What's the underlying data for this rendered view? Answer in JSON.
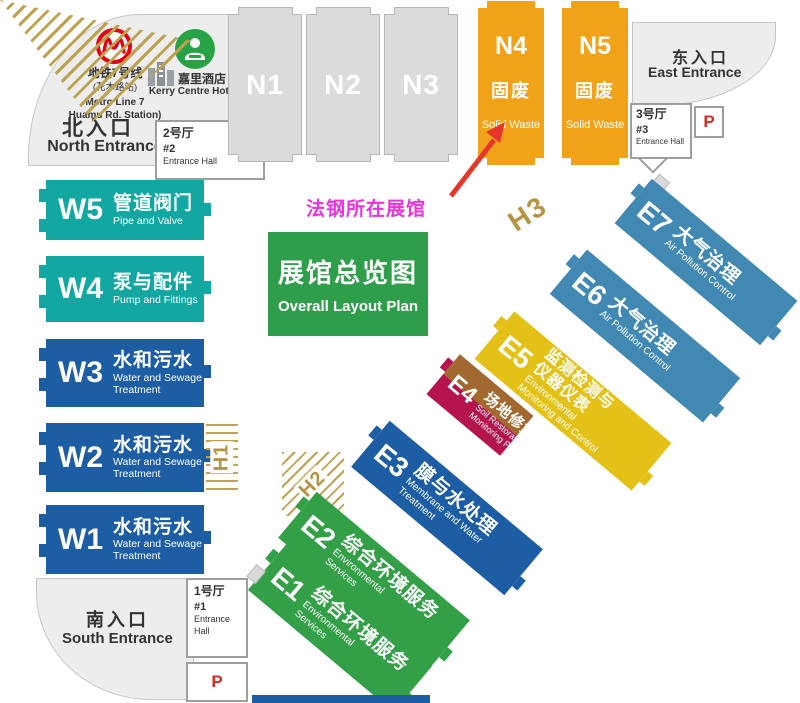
{
  "title_box": {
    "cn": "展馆总览图",
    "en": "Overall Layout Plan"
  },
  "annotation": {
    "label": "法钢所在展馆"
  },
  "north": {
    "metro_line_cn": "地铁7号线",
    "metro_station_cn": "(花木路站)",
    "metro_line_en": "Metro Line 7",
    "metro_station_en": "Huamu Rd. Station)",
    "hotel_cn": "嘉里酒店",
    "hotel_en": "Kerry Centre Hotel",
    "entrance_cn": "北入口",
    "entrance_en": "North Entrance",
    "hall_cn": "2号厅",
    "hall_no": "#2",
    "hall_en": "Entrance Hall"
  },
  "east": {
    "entrance_cn": "东入口",
    "entrance_en": "East Entrance",
    "hall_cn": "3号厅",
    "hall_no": "#3",
    "hall_en": "Entrance Hall",
    "parking": "P"
  },
  "south": {
    "entrance_cn": "南入口",
    "entrance_en": "South Entrance",
    "hall_cn": "1号厅",
    "hall_no": "#1",
    "hall_en": "Entrance Hall",
    "parking": "P"
  },
  "n_halls": [
    {
      "id": "N1",
      "cn": "",
      "en": ""
    },
    {
      "id": "N2",
      "cn": "",
      "en": ""
    },
    {
      "id": "N3",
      "cn": "",
      "en": ""
    },
    {
      "id": "N4",
      "cn": "固废",
      "en": "Solid Waste"
    },
    {
      "id": "N5",
      "cn": "固废",
      "en": "Solid Waste"
    }
  ],
  "w_halls": [
    {
      "id": "W5",
      "cn": "管道阀门",
      "en1": "Pipe and Valve",
      "en2": ""
    },
    {
      "id": "W4",
      "cn": "泵与配件",
      "en1": "Pump and Fittings",
      "en2": ""
    },
    {
      "id": "W3",
      "cn": "水和污水",
      "en1": "Water and Sewage",
      "en2": "Treatment"
    },
    {
      "id": "W2",
      "cn": "水和污水",
      "en1": "Water and Sewage",
      "en2": "Treatment"
    },
    {
      "id": "W1",
      "cn": "水和污水",
      "en1": "Water and Sewage",
      "en2": "Treatment"
    }
  ],
  "e_halls": [
    {
      "id": "E7",
      "cn1": "大气治理",
      "cn2": "",
      "en1": "Air Pollution Control",
      "en2": ""
    },
    {
      "id": "E6",
      "cn1": "大气治理",
      "cn2": "",
      "en1": "Air Pollution Control",
      "en2": ""
    },
    {
      "id": "E5",
      "cn1": "监测检测与",
      "cn2": "仪器仪表",
      "en1": "Environmental",
      "en2": "Monitoring and Control"
    },
    {
      "id": "E4",
      "cn1": "场地修复/监测",
      "cn2": "",
      "en1": "Soil Restoration,",
      "en2": "Monitoring Pavilions"
    },
    {
      "id": "E3",
      "cn1": "膜与水处理",
      "cn2": "",
      "en1": "Membrane and Water",
      "en2": "Treatment"
    },
    {
      "id": "E2",
      "cn1": "综合环境服务",
      "cn2": "",
      "en1": "Environmental",
      "en2": "Services"
    },
    {
      "id": "E1",
      "cn1": "综合环境服务",
      "cn2": "",
      "en1": "Environmental",
      "en2": "Services"
    }
  ],
  "h_zones": [
    {
      "id": "H1"
    },
    {
      "id": "H2"
    },
    {
      "id": "H3"
    }
  ],
  "colors": {
    "orange": "#f0a319",
    "teal": "#12a7a1",
    "blue": "#1d5da4",
    "steel_blue": "#4189b3",
    "yellow": "#e4c116",
    "green": "#33a047",
    "title_green": "#2f9e4b",
    "crimson": "#b5134e",
    "brown": "#a1692f",
    "gold_hatch": "#b39543",
    "magenta_annotation": "#ea33dc",
    "arrow_red": "#e5382b",
    "metro_red": "#e60012",
    "parking_red": "#d42a24"
  }
}
